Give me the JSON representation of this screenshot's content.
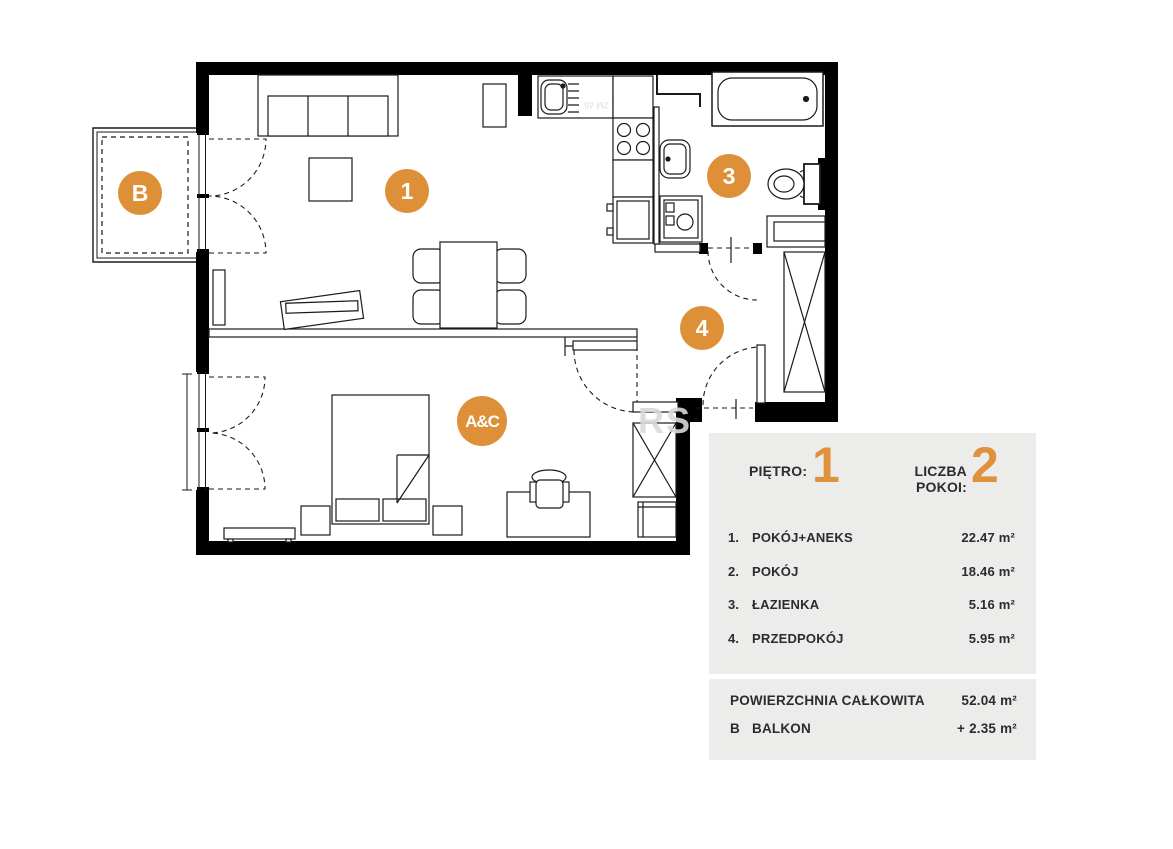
{
  "panel": {
    "floor_label": "PIĘTRO:",
    "floor_value": "1",
    "rooms_count_label": "LICZBA POKOI:",
    "rooms_count_value": "2",
    "rooms": [
      {
        "num": "1.",
        "name": "POKÓJ+ANEKS",
        "area": "22.47 m²"
      },
      {
        "num": "2.",
        "name": "POKÓJ",
        "area": "18.46 m²"
      },
      {
        "num": "3.",
        "name": "ŁAZIENKA",
        "area": "5.16 m²"
      },
      {
        "num": "4.",
        "name": "PRZEDPOKÓJ",
        "area": "5.95 m²"
      }
    ],
    "total_label": "POWIERZCHNIA CAŁKOWITA",
    "total_area": "52.04 m²",
    "balcony_num": "B",
    "balcony_label": "BALKON",
    "balcony_area": "+  2.35 m²"
  },
  "plan": {
    "markers": {
      "room1": "1",
      "room2_logo": "A&C",
      "room3": "3",
      "room4": "4",
      "balcony": "B"
    },
    "watermark": {
      "text_fragment": "RS",
      "dim_artifact": "2M 45"
    },
    "colors": {
      "accent_orange": "#DE9038",
      "panel_bg": "#ECECEB",
      "wall": "#000000",
      "watermark_gray": "#D9D9D9"
    }
  }
}
